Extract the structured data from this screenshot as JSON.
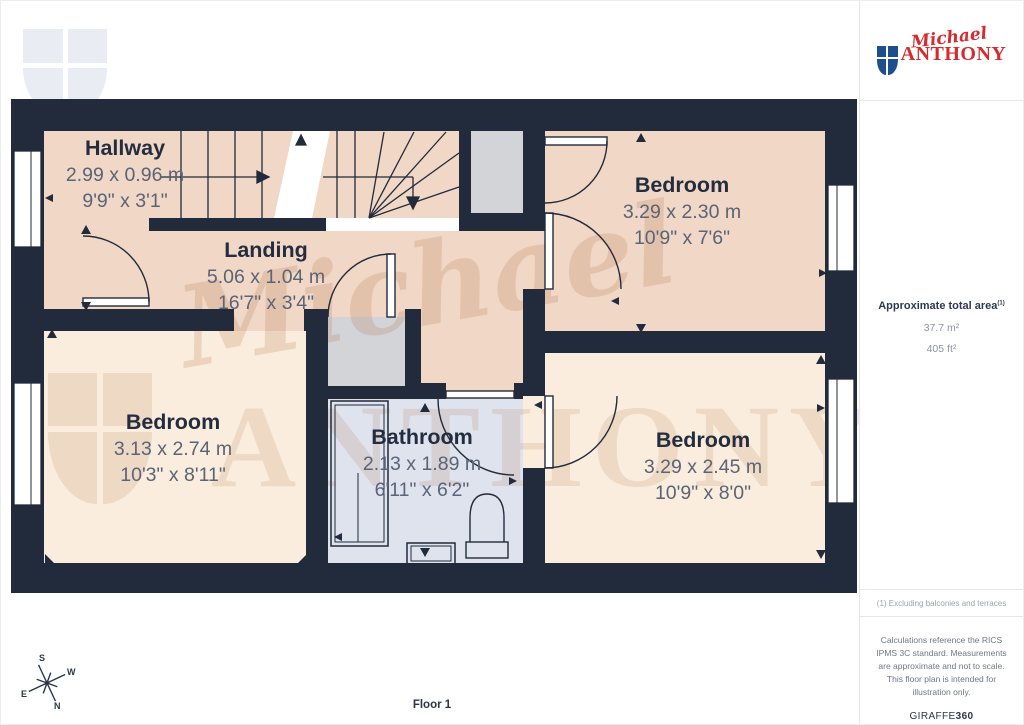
{
  "branding": {
    "logo": {
      "script": "Michael",
      "serif": "ANTHONY"
    },
    "watermark": {
      "script": "Michael",
      "serif": "ANTHONY"
    }
  },
  "floor_label": "Floor 1",
  "compass": {
    "n": "N",
    "s": "S",
    "e": "E",
    "w": "W"
  },
  "rooms": [
    {
      "id": "hallway",
      "name": "Hallway",
      "metric": "2.99 x 0.96 m",
      "imperial": "9'9\" x 3'1\""
    },
    {
      "id": "landing",
      "name": "Landing",
      "metric": "5.06 x 1.04 m",
      "imperial": "16'7\" x 3'4\""
    },
    {
      "id": "bedroom-top-right",
      "name": "Bedroom",
      "metric": "3.29 x 2.30 m",
      "imperial": "10'9\" x 7'6\""
    },
    {
      "id": "bedroom-left",
      "name": "Bedroom",
      "metric": "3.13 x 2.74 m",
      "imperial": "10'3\" x 8'11\""
    },
    {
      "id": "bathroom",
      "name": "Bathroom",
      "metric": "2.13 x 1.89 m",
      "imperial": "6'11\" x 6'2\""
    },
    {
      "id": "bedroom-bottom-right",
      "name": "Bedroom",
      "metric": "3.29 x 2.45 m",
      "imperial": "10'9\" x 8'0\""
    }
  ],
  "sidebar": {
    "area_heading": "Approximate total area",
    "area_footnote_marker": "(1)",
    "area_m2": "37.7 m²",
    "area_ft2": "405 ft²",
    "footnote": "(1) Excluding balconies and terraces",
    "disclaimer": "Calculations reference the RICS IPMS 3C standard. Measurements are approximate and not to scale. This floor plan is intended for illustration only.",
    "brand_normal": "GIRAFFE",
    "brand_bold": "360"
  },
  "colors": {
    "wall": "#212b3b",
    "room_peach": "#f1d7c6",
    "room_peach_light": "#faeddd",
    "bathroom": "#dee3ee",
    "closet_gray": "#d2d4d8",
    "brand_red": "#d62a2c",
    "brand_blue": "#1d4f8f"
  }
}
